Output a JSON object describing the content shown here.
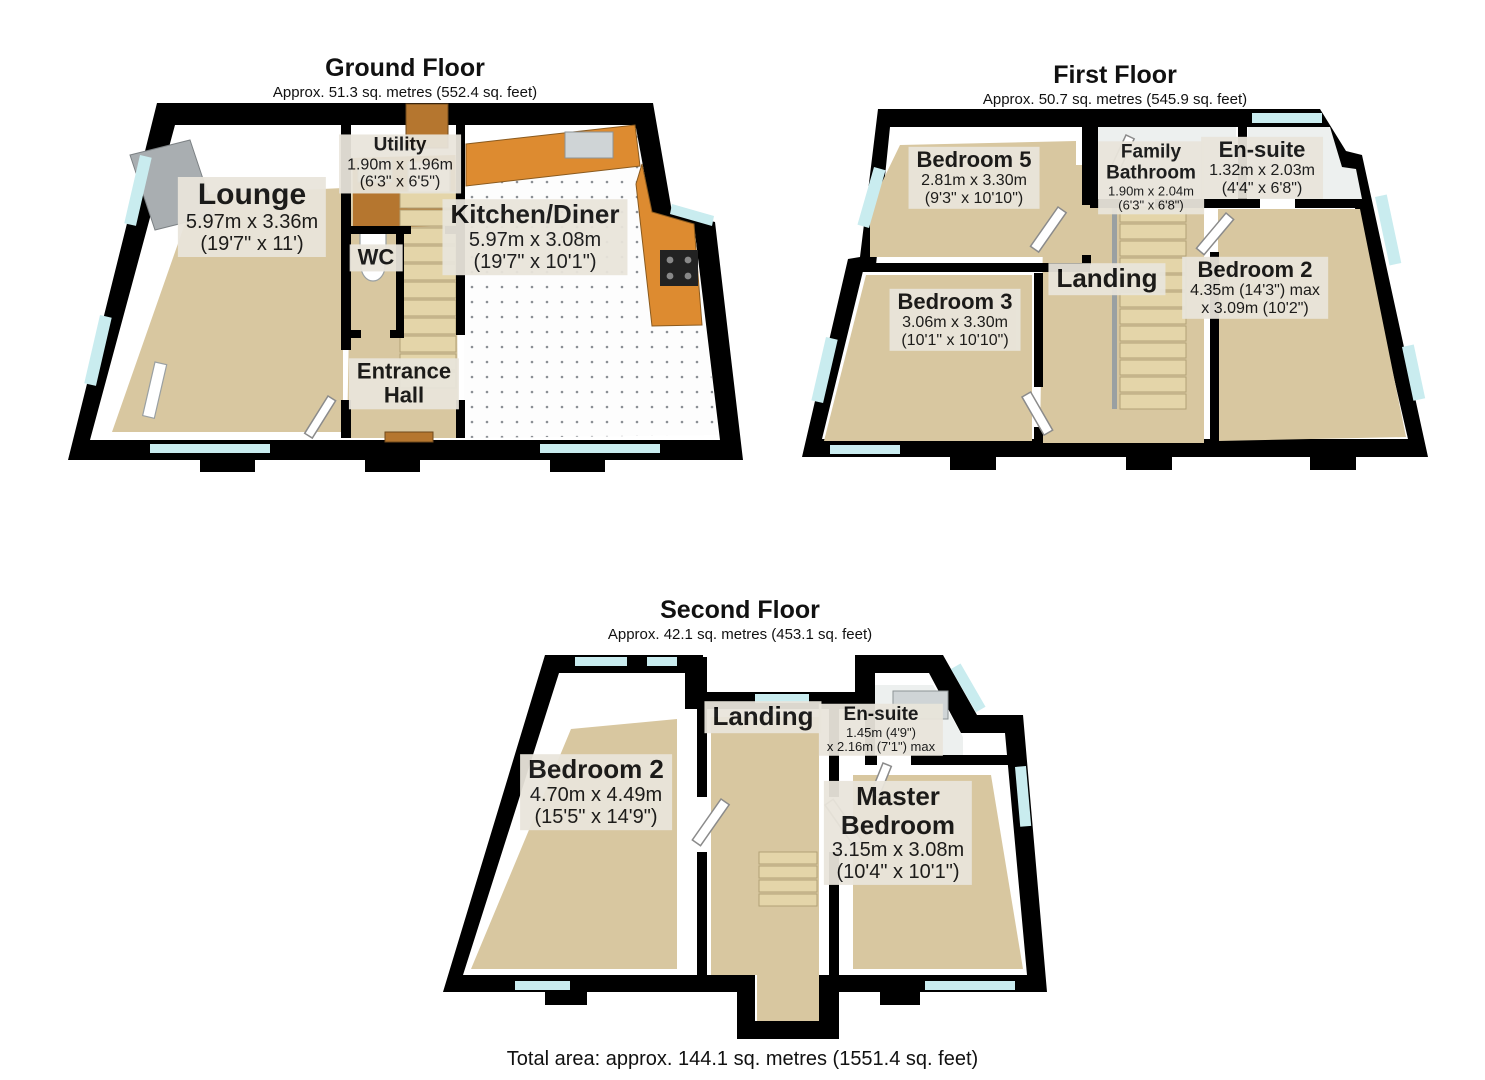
{
  "page": {
    "total_area": "Total area: approx. 144.1 sq. metres (1551.4 sq. feet)"
  },
  "colors": {
    "wall": "#000000",
    "floor-beige": "#d8c7a0",
    "window": "#c9ecef",
    "counter": "#dd8b30",
    "door": "#b5762f",
    "label-bg": "#e9e5db"
  },
  "floors": {
    "ground": {
      "title": "Ground Floor",
      "subtitle": "Approx. 51.3 sq. metres (552.4 sq. feet)",
      "rooms": {
        "lounge": {
          "name": "Lounge",
          "metric": "5.97m x 3.36m",
          "imperial": "(19'7\" x 11')"
        },
        "utility": {
          "name": "Utility",
          "metric": "1.90m x 1.96m",
          "imperial": "(6'3\" x 6'5\")"
        },
        "kitchen": {
          "name": "Kitchen/Diner",
          "metric": "5.97m x 3.08m",
          "imperial": "(19'7\" x 10'1\")"
        },
        "wc": {
          "name": "WC"
        },
        "entrance": {
          "name_line1": "Entrance",
          "name_line2": "Hall"
        }
      }
    },
    "first": {
      "title": "First Floor",
      "subtitle": "Approx. 50.7 sq. metres (545.9 sq. feet)",
      "rooms": {
        "bedroom5": {
          "name": "Bedroom 5",
          "metric": "2.81m x 3.30m",
          "imperial": "(9'3\" x 10'10\")"
        },
        "family_bathroom": {
          "name_line1": "Family",
          "name_line2": "Bathroom",
          "metric": "1.90m x 2.04m",
          "imperial": "(6'3\" x 6'8\")"
        },
        "ensuite": {
          "name": "En-suite",
          "metric": "1.32m x 2.03m",
          "imperial": "(4'4\" x 6'8\")"
        },
        "bedroom3": {
          "name": "Bedroom 3",
          "metric": "3.06m x 3.30m",
          "imperial": "(10'1\" x 10'10\")"
        },
        "landing": {
          "name": "Landing"
        },
        "bedroom2": {
          "name": "Bedroom 2",
          "metric": "4.35m (14'3\") max",
          "imperial": "x 3.09m (10'2\")"
        }
      }
    },
    "second": {
      "title": "Second Floor",
      "subtitle": "Approx. 42.1 sq. metres (453.1 sq. feet)",
      "rooms": {
        "bedroom2": {
          "name": "Bedroom 2",
          "metric": "4.70m x 4.49m",
          "imperial": "(15'5\" x 14'9\")"
        },
        "landing": {
          "name": "Landing"
        },
        "ensuite": {
          "name": "En-suite",
          "metric": "1.45m (4'9\")",
          "imperial": "x 2.16m (7'1\") max"
        },
        "master": {
          "name_line1": "Master",
          "name_line2": "Bedroom",
          "metric": "3.15m x 3.08m",
          "imperial": "(10'4\" x 10'1\")"
        }
      }
    }
  }
}
